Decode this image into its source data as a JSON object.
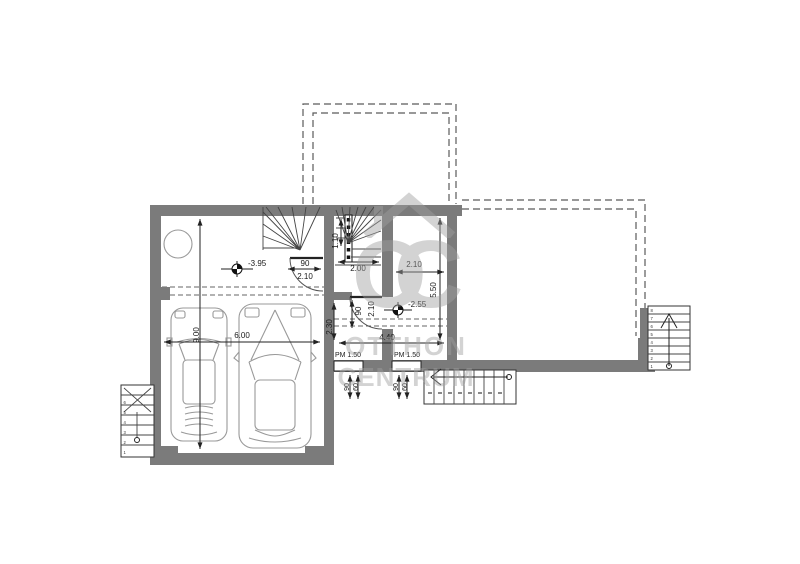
{
  "watermark": {
    "logo_o": "O",
    "logo_c": "C",
    "line1": "OTTHON",
    "line2": "CENTRUM"
  },
  "levels": {
    "garage_level": "-3.95",
    "hall_level": "-2.55"
  },
  "dimensions": {
    "garage_width": "6.00",
    "garage_depth": "9.00",
    "garage_door_width": "90",
    "garage_door_height": "2.10",
    "stair_flight_width": "1.10",
    "stair_width": "2.00",
    "hall_width": "2.10",
    "hall_depth": "5.50",
    "entry_door_width": "90",
    "entry_door_height": "2.10",
    "vestibule_depth": "2.30",
    "hall_length": "4.40",
    "window1_parapet": "PM 1.50",
    "window2_parapet": "PM 1.50",
    "window1_width": "90",
    "window1_sill": "60",
    "window2_width": "90",
    "window2_sill": "60"
  },
  "stairs": {
    "right_numbers": [
      "1",
      "2",
      "3",
      "4",
      "5",
      "6",
      "7",
      "8"
    ],
    "left_numbers": [
      "1",
      "2",
      "3",
      "4",
      "5",
      "6"
    ]
  },
  "colors": {
    "wall": "#7b7b7b",
    "line": "#222222",
    "thin_line": "#999999",
    "dashed": "#5a5a5a",
    "watermark": "#a8a8a8",
    "background": "#ffffff"
  }
}
